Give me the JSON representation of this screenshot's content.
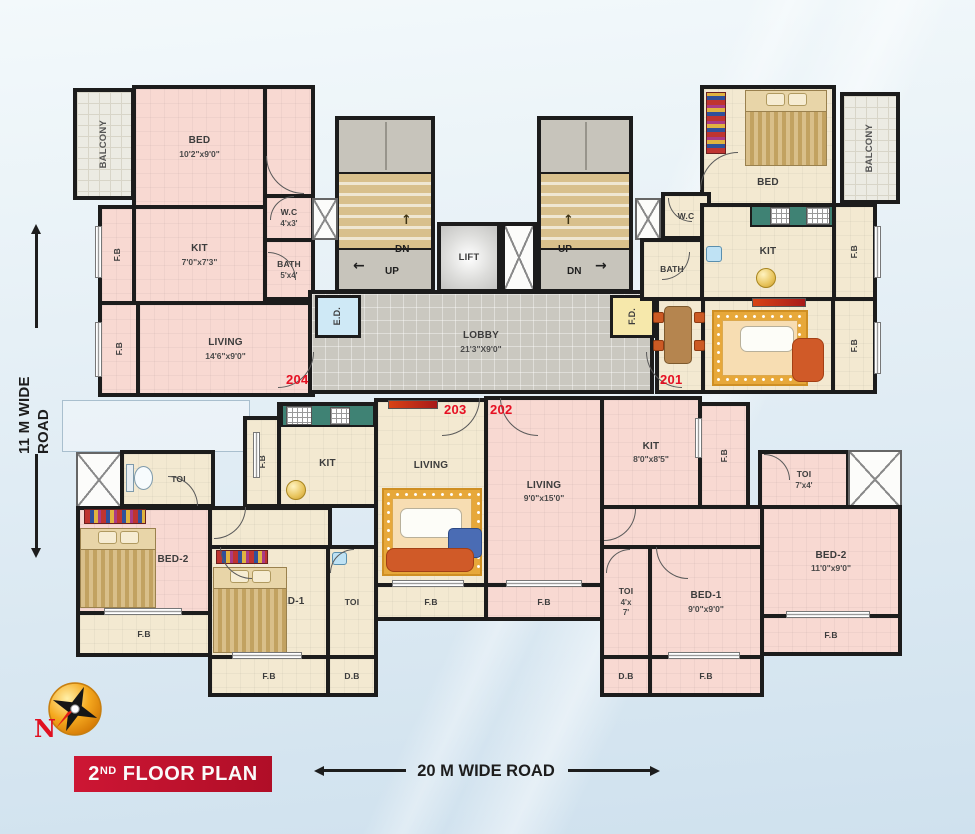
{
  "title": {
    "num": "2",
    "sup": "ND",
    "rest": "FLOOR PLAN"
  },
  "roads": {
    "bottom": "20 M WIDE ROAD",
    "left": "11 M WIDE ROAD"
  },
  "compass": {
    "label": "N"
  },
  "units": {
    "u201": "201",
    "u202": "202",
    "u203": "203",
    "u204": "204"
  },
  "core": {
    "lobby": {
      "label": "LOBBY",
      "dims": "21'3\"X9'0\""
    },
    "lift": {
      "label": "LIFT"
    },
    "stairs": {
      "left_top": "DN",
      "left_bottom": "UP",
      "right_top": "UP",
      "right_bottom": "DN"
    },
    "ed": {
      "label": "E.D."
    },
    "fd": {
      "label": "F.D."
    }
  },
  "icons": {
    "up": "↑",
    "left": "←",
    "right": "→"
  },
  "rooms": {
    "balcony_tl": {
      "label": "BALCONY"
    },
    "bed_tl": {
      "label": "BED",
      "dims": "10'2\"x9'0\""
    },
    "fb_tl1": {
      "label": "F.B"
    },
    "kit_tl": {
      "label": "KIT",
      "dims": "7'0\"x7'3\""
    },
    "wc_tl": {
      "label": "W.C",
      "dims": "4'x3'"
    },
    "bath_tl": {
      "label": "BATH",
      "dims": "5'x4'"
    },
    "fb_tl2": {
      "label": "F.B"
    },
    "living_tl": {
      "label": "LIVING",
      "dims": "14'6\"x9'0\""
    },
    "bed_tr": {
      "label": "BED"
    },
    "balcony_tr": {
      "label": "BALCONY"
    },
    "wc_tr": {
      "label": "W.C"
    },
    "bath_tr": {
      "label": "BATH"
    },
    "kit_tr": {
      "label": "KIT"
    },
    "fb_tr1": {
      "label": "F.B"
    },
    "living_tr": {
      "label": "LIVING"
    },
    "fb_tr2": {
      "label": "F.B"
    },
    "toi_ll": {
      "label": "TOI"
    },
    "fb_ll": {
      "label": "F.B"
    },
    "kit_203": {
      "label": "KIT"
    },
    "bed2_204": {
      "label": "BED-2"
    },
    "bed1_204": {
      "label": "BED-1"
    },
    "toi_204": {
      "label": "TOI"
    },
    "fb_204l": {
      "label": "F.B"
    },
    "fb_204b": {
      "label": "F.B"
    },
    "db_204": {
      "label": "D.B"
    },
    "living_203": {
      "label": "LIVING"
    },
    "fb_203b": {
      "label": "F.B"
    },
    "living_202": {
      "label": "LIVING",
      "dims": "9'0\"x15'0\""
    },
    "fb_202b1": {
      "label": "F.B"
    },
    "kit_202": {
      "label": "KIT",
      "dims": "8'0\"x8'5\""
    },
    "fb_202m": {
      "label": "F.B"
    },
    "toi_202r": {
      "label": "TOI",
      "dims": "7'x4'"
    },
    "bed2_202": {
      "label": "BED-2",
      "dims": "11'0\"x9'0\""
    },
    "fb_202br": {
      "label": "F.B"
    },
    "bed1_202": {
      "label": "BED-1",
      "dims": "9'0\"x9'0\""
    },
    "toi_202b": {
      "label": "TOI",
      "d1": "4'x",
      "d2": "7'"
    },
    "db_202": {
      "label": "D.B"
    },
    "fb_202b2": {
      "label": "F.B"
    }
  },
  "colors": {
    "room_pink": "#f8d9d2",
    "room_cream": "#f3e9d1",
    "wall": "#1c1c1c",
    "lobby_gray": "#cac8c0",
    "stair_step": "#d8c08c",
    "counter_green": "#3f8274",
    "ed_blue": "#cfe9f6",
    "fd_yellow": "#f6e8ab",
    "unit_red": "#e60f22",
    "banner_red": "#b00e27",
    "compass_gold": "#f5a91f"
  }
}
